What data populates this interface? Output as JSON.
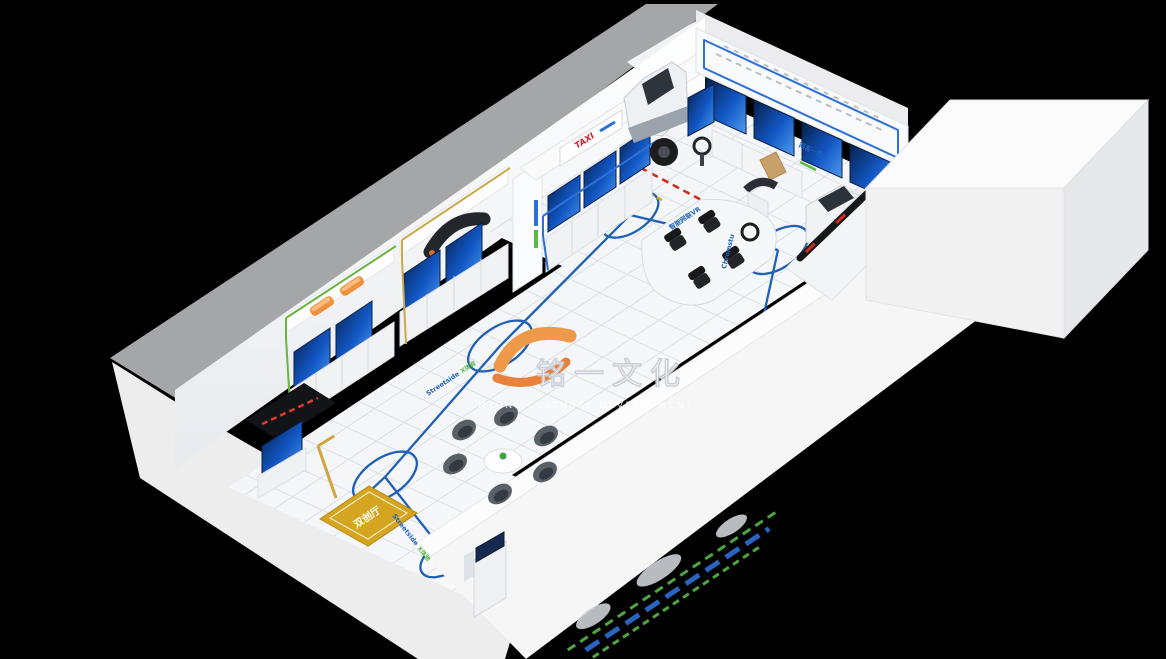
{
  "watermark": {
    "name": "铭一文化",
    "subtitle": "MYONE CULTURAL DEVELOPMENT"
  },
  "signs": {
    "taxi": "TAXI",
    "muck_truck_zone": "渣土",
    "two_passenger_one_danger": "两客一危",
    "room_floor_mat": "双创厅"
  },
  "floor_labels": {
    "route_blue": "Streetside",
    "route_green": "X体验",
    "route2_blue": "Streetside",
    "route2_green": "X体验",
    "simulator_label": "智能网联VR",
    "vertical_label": "Chromstu"
  },
  "colors": {
    "background": "#000000",
    "route_blue": "#2160b4",
    "screen_blue": "#1257c4",
    "trim_green": "#6cb33f",
    "trim_gold": "#c9a94a",
    "trim_blue": "#2e6fd8",
    "accent_orange": "#f2913d",
    "mat_gold": "#d6a51f",
    "led_red": "#e03a2a",
    "taxi_red": "#d1222a",
    "watermark_orange": "#ef9a4a"
  }
}
